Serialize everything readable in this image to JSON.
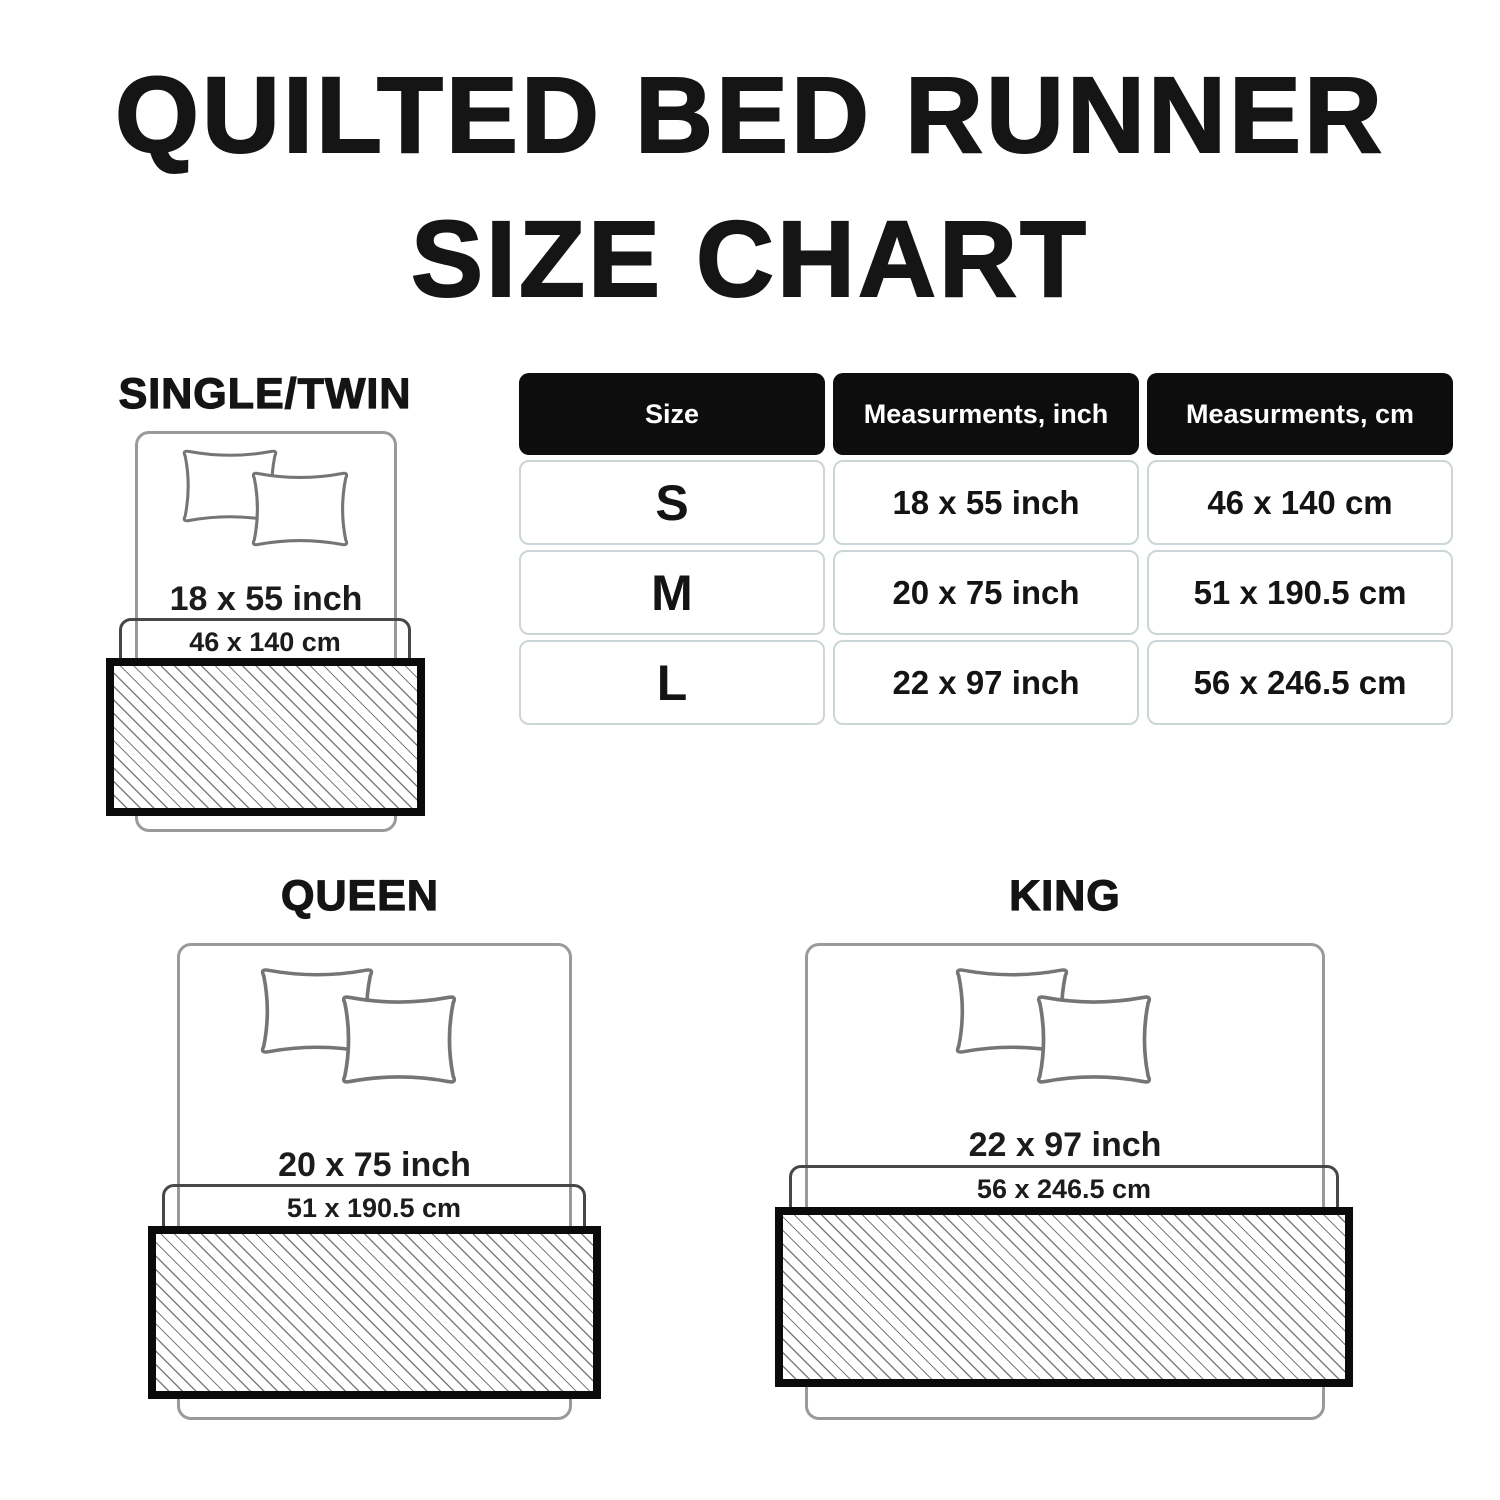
{
  "title": {
    "line1": "QUILTED BED RUNNER",
    "line2": "SIZE CHART"
  },
  "size_table": {
    "headers": {
      "size": "Size",
      "inch": "Measurments, inch",
      "cm": "Measurments, cm"
    },
    "rows": [
      {
        "size": "S",
        "inch": "18 x 55 inch",
        "cm": "46 x 140 cm"
      },
      {
        "size": "M",
        "inch": "20 x 75 inch",
        "cm": "51 x 190.5 cm"
      },
      {
        "size": "L",
        "inch": "22 x 97 inch",
        "cm": "56 x 246.5 cm"
      }
    ]
  },
  "diagrams": {
    "single_twin": {
      "label": "SINGLE/TWIN",
      "inch": "18 x 55 inch",
      "cm": "46 x 140 cm"
    },
    "queen": {
      "label": "QUEEN",
      "inch": "20 x 75 inch",
      "cm": "51 x 190.5 cm"
    },
    "king": {
      "label": "KING",
      "inch": "22 x 97 inch",
      "cm": "56 x 246.5 cm"
    }
  },
  "colors": {
    "header_black": "#0d0d0d",
    "runner_border_black": "#0b0b0b",
    "bed_outline_gray": "#9a9a9a",
    "sheet_outline_gray": "#474747",
    "cell_border_gray": "#ccd6d8",
    "hatch_line_gray": "#7e7e7e"
  }
}
